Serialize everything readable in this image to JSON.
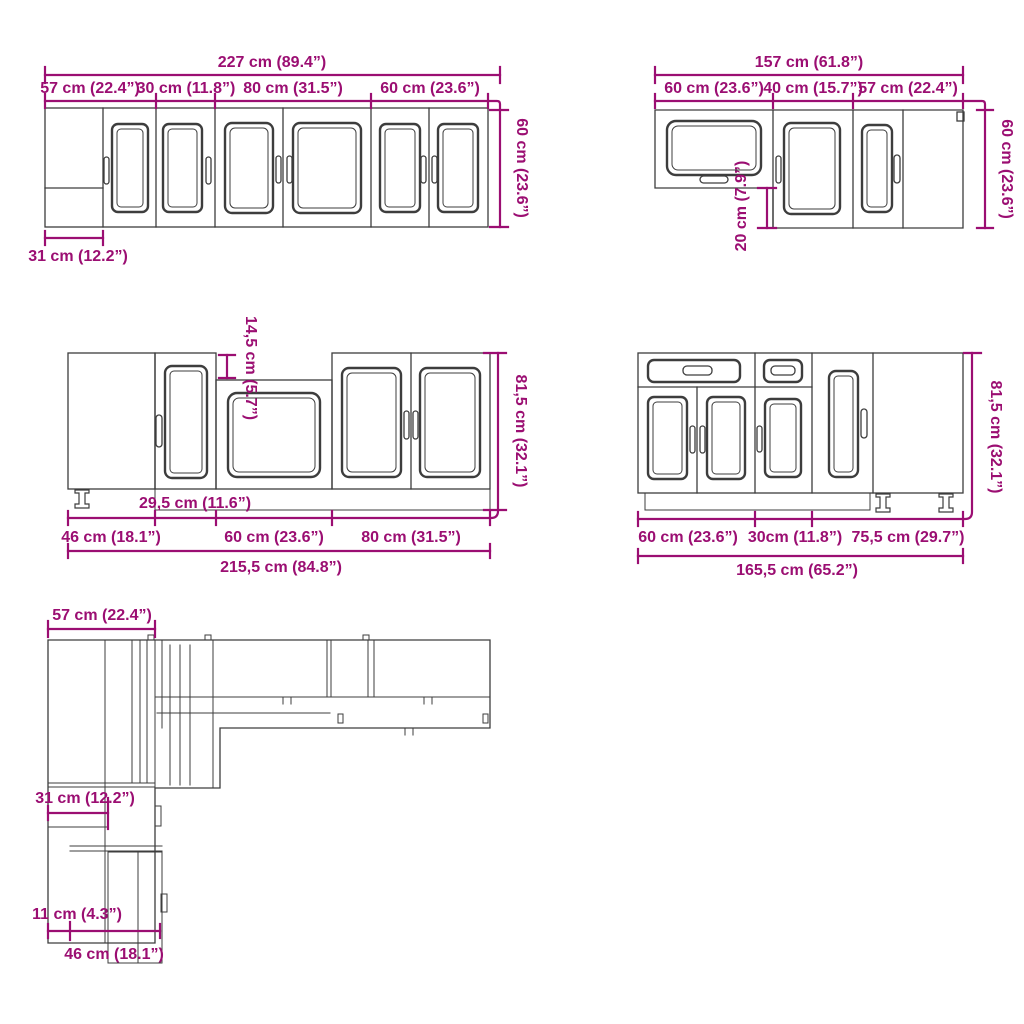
{
  "colors": {
    "dimension": "#9b0e72",
    "line": "#3d3d3d",
    "background": "#ffffff"
  },
  "diagrams": {
    "wall_row": {
      "total": "227 cm (89.4”)",
      "segments": [
        "57 cm (22.4”)",
        "30 cm (11.8”)",
        "80 cm (31.5”)",
        "60 cm (23.6”)"
      ],
      "height": "60 cm (23.6”)",
      "blind_width": "31 cm (12.2”)"
    },
    "wall_corner": {
      "total": "157 cm (61.8”)",
      "segments": [
        "60 cm (23.6”)",
        "40 cm (15.7”)",
        "57 cm (22.4”)"
      ],
      "height": "60 cm (23.6”)",
      "drop": "20 cm (7.9”)"
    },
    "base_row": {
      "gap": "14,5 cm (5.7”)",
      "height": "81,5 cm (32.1”)",
      "inner_width": "29,5 cm (11.6”)",
      "segments": [
        "46 cm (18.1”)",
        "60 cm (23.6”)",
        "80 cm (31.5”)"
      ],
      "total": "215,5 cm (84.8”)"
    },
    "base_corner": {
      "segments": [
        "60 cm (23.6”)",
        "30cm (11.8”)",
        "75,5 cm (29.7”)"
      ],
      "total": "165,5 cm (65.2”)",
      "height": "81,5 cm (32.1”)"
    },
    "plan": {
      "depth": "57 cm (22.4”)",
      "dim_31": "31 cm (12.2”)",
      "dim_11": "11 cm (4.3”)",
      "dim_46": "46 cm (18.1”)"
    }
  }
}
